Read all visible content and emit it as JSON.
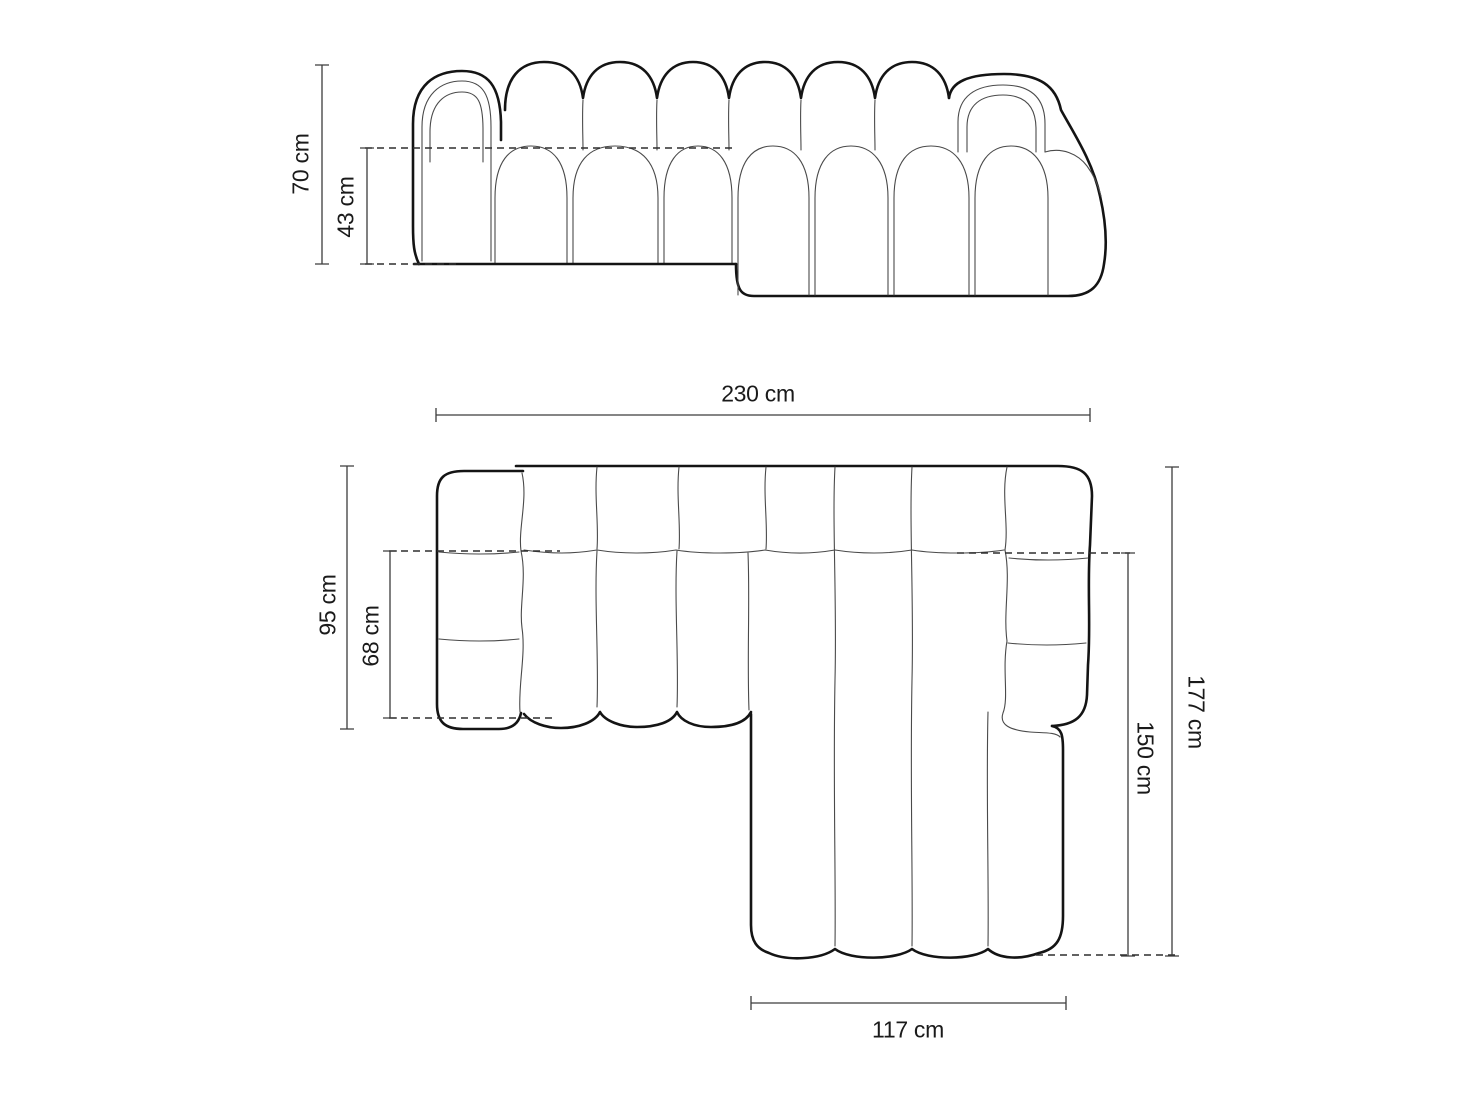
{
  "front_view": {
    "overall_height": "70 cm",
    "seat_height": "43 cm"
  },
  "top_view": {
    "overall_width": "230 cm",
    "left_depth": "95 cm",
    "left_seat_depth": "68 cm",
    "overall_depth": "177 cm",
    "chaise_depth": "150 cm",
    "chaise_width": "117 cm"
  },
  "colors": {
    "background": "#ffffff",
    "outline_bold": "#141414",
    "outline_thin": "#4a4a4a",
    "dimension": "#3c3c3c"
  }
}
